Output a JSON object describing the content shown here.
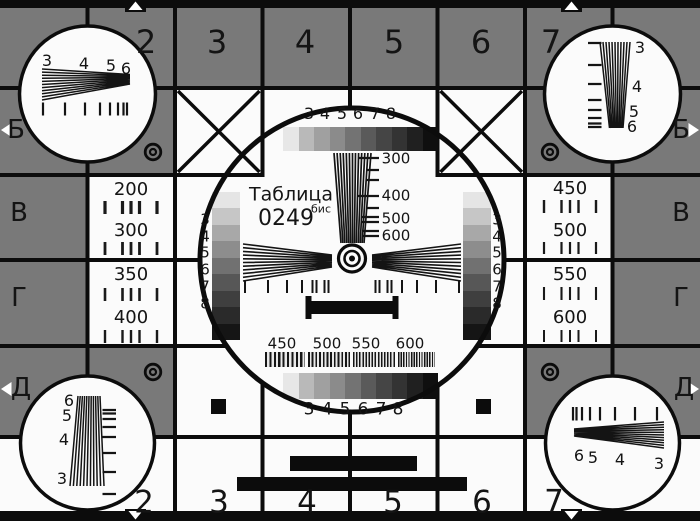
{
  "colors": {
    "background": "#797979",
    "ink": "#0c0c0c",
    "card_white": "#fbfbfb",
    "grayscale_horizontal": [
      "#e7e7e7",
      "#b9b9b9",
      "#a0a0a0",
      "#8b8b8b",
      "#737373",
      "#5a5a5a",
      "#454545",
      "#333333",
      "#202020",
      "#0f0f0f"
    ],
    "grayscale_vertical": [
      "#e5e5e5",
      "#c6c6c6",
      "#a8a8a8",
      "#8d8d8d",
      "#717171",
      "#575757",
      "#3f3f3f",
      "#2a2a2a",
      "#151515"
    ]
  },
  "top_row": {
    "labels": [
      "2",
      "3",
      "4",
      "5",
      "6",
      "7"
    ]
  },
  "bottom_row": {
    "labels": [
      "2",
      "3",
      "4",
      "5",
      "6",
      "7"
    ]
  },
  "side_rows_left": [
    "Б",
    "В",
    "Г",
    "Д"
  ],
  "side_rows_right": [
    "Б",
    "В",
    "Г",
    "Д"
  ],
  "corner_circles": {
    "top_left": {
      "numbers": [
        "3",
        "4",
        "5",
        "6"
      ]
    },
    "top_right": {
      "numbers": [
        "3",
        "4",
        "5",
        "6"
      ]
    },
    "bottom_left": {
      "numbers": [
        "6",
        "5",
        "4",
        "3"
      ]
    },
    "bottom_right": {
      "numbers": [
        "6",
        "5",
        "4",
        "3"
      ]
    }
  },
  "center_circle": {
    "title": "Таблица",
    "code": "0249",
    "code_suffix": "бис",
    "grayscale_top_labels": [
      "3",
      "4",
      "5",
      "6",
      "7",
      "8"
    ],
    "grayscale_bottom_labels": [
      "3",
      "4",
      "5",
      "6",
      "7",
      "8"
    ],
    "freq_wedge_labels": [
      "300",
      "400",
      "500",
      "600"
    ],
    "freq_bar_labels": [
      "450",
      "500",
      "550",
      "600"
    ],
    "ladder_left_labels": [
      "3",
      "4",
      "5",
      "6",
      "7",
      "8"
    ],
    "ladder_right_labels": [
      "3",
      "4",
      "5",
      "6",
      "7",
      "8"
    ]
  },
  "side_cells": {
    "left": [
      "200",
      "300",
      "350",
      "400"
    ],
    "right": [
      "450",
      "500",
      "550",
      "600"
    ]
  }
}
